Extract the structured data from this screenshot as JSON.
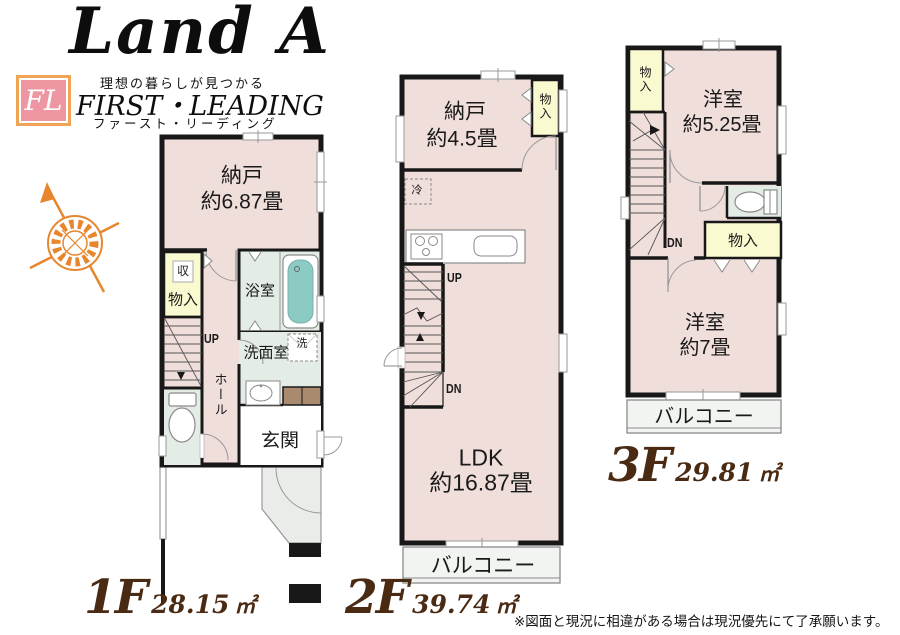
{
  "brand": {
    "logo_text": "Land A",
    "tagline": "理想の暮らしが見つかる",
    "badge": "FL",
    "company_en": "FIRST・LEADING",
    "company_ja": "ファースト・リーディング"
  },
  "floors": [
    {
      "id": "1f",
      "label": "1F",
      "area_value": "28.15",
      "area_unit": "㎡",
      "rooms": {
        "storage": "納戸",
        "storage_size": "約6.87畳",
        "closet_top": "収",
        "closet": "物入",
        "bath": "浴室",
        "up": "UP",
        "hall": "ホール",
        "washroom": "洗面室",
        "washer": "洗",
        "entrance": "玄関"
      }
    },
    {
      "id": "2f",
      "label": "2F",
      "area_value": "39.74",
      "area_unit": "㎡",
      "rooms": {
        "storage": "納戸",
        "storage_size": "約4.5畳",
        "closet": "物入",
        "fridge": "冷",
        "up": "UP",
        "dn": "DN",
        "ldk": "LDK",
        "ldk_size": "約16.87畳",
        "balcony": "バルコニー"
      }
    },
    {
      "id": "3f",
      "label": "3F",
      "area_value": "29.81",
      "area_unit": "㎡",
      "rooms": {
        "closet_top": "物入",
        "western_a": "洋室",
        "western_a_size": "約5.25畳",
        "dn": "DN",
        "closet_mid": "物入",
        "western_b": "洋室",
        "western_b_size": "約7畳",
        "balcony": "バルコニー"
      }
    }
  ],
  "footer": {
    "disclaimer": "※図面と現況に相違がある場合は現況優先にて了承願います。"
  },
  "colors": {
    "room_pink": "#f0dedb",
    "closet_yellow": "#fafad0",
    "wet_area": "#e4ece6",
    "tub_teal": "#8ccbc4",
    "wall_black": "#181818",
    "compass_orange": "#e8862e",
    "floor_label_brown": "#4a2a12",
    "badge_pink": "#ee97a2",
    "badge_border_orange": "#f0a455",
    "cabinet_brown": "#aa8a6e"
  }
}
